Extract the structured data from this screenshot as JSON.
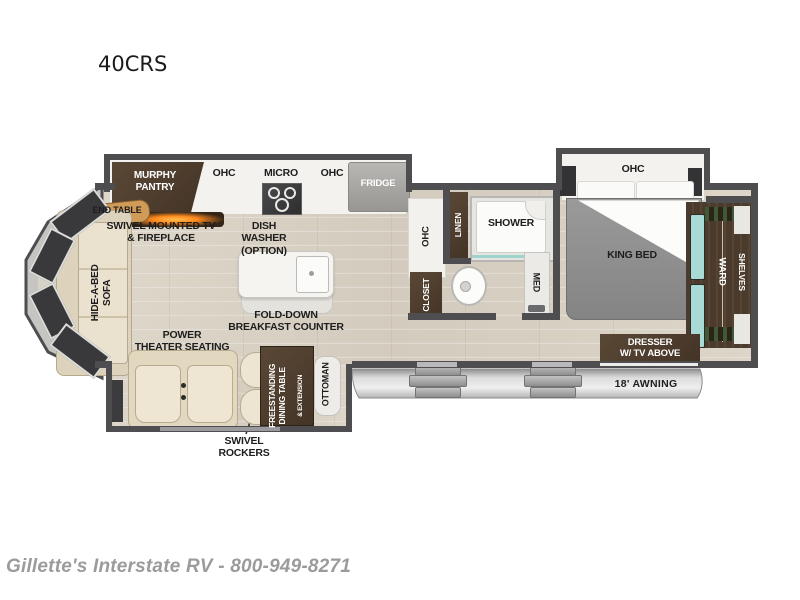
{
  "page": {
    "model_title": "40CRS",
    "footer_text": "Gillette's Interstate RV - 800-949-8271"
  },
  "colors": {
    "wall": "#4e4e50",
    "wood_floor": "#d8d1c4",
    "cabinet_brown": "#4d3c2f",
    "cream_furniture": "#eae2cf",
    "counter_white": "#f3f2ee",
    "bed_gray": "#8e8e8e",
    "teal_accent": "#a8dbd6",
    "awning_gray": "#d6d6d6",
    "fireplace_orange": "#ff8a1e",
    "window_dark": "#39393b",
    "footer_gray": "#9b9b9b"
  },
  "labels": {
    "murphy_pantry": "MURPHY\nPANTRY",
    "ohc_kitchen_left": "OHC",
    "micro": "MICRO",
    "ohc_kitchen_right": "OHC",
    "fridge": "FRIDGE",
    "end_table": "END TABLE",
    "swivel_tv_fireplace": "SWIVEL MOUNTED TV\n& FIREPLACE",
    "hide_a_bed_sofa": "HIDE-A-BED\nSOFA",
    "dish_washer": "DISH\nWASHER\n(OPTION)",
    "fold_down_counter": "FOLD-DOWN\nBREAKFAST COUNTER",
    "power_theater_seating": "POWER\nTHEATER SEATING",
    "swivel_rockers": "SWIVEL\nROCKERS",
    "dining_table": "FREESTANDING\nDINING TABLE",
    "dining_table_extension": "& EXTENSION",
    "ottoman": "OTTOMAN",
    "ohc_bath": "OHC",
    "linen": "LINEN",
    "shower": "SHOWER",
    "closet": "CLOSET",
    "med": "MED",
    "ohc_bedroom": "OHC",
    "king_bed": "KING BED",
    "ward": "WARD",
    "shelves": "SHELVES",
    "dresser": "DRESSER\nW/ TV ABOVE",
    "awning": "18' AWNING"
  }
}
